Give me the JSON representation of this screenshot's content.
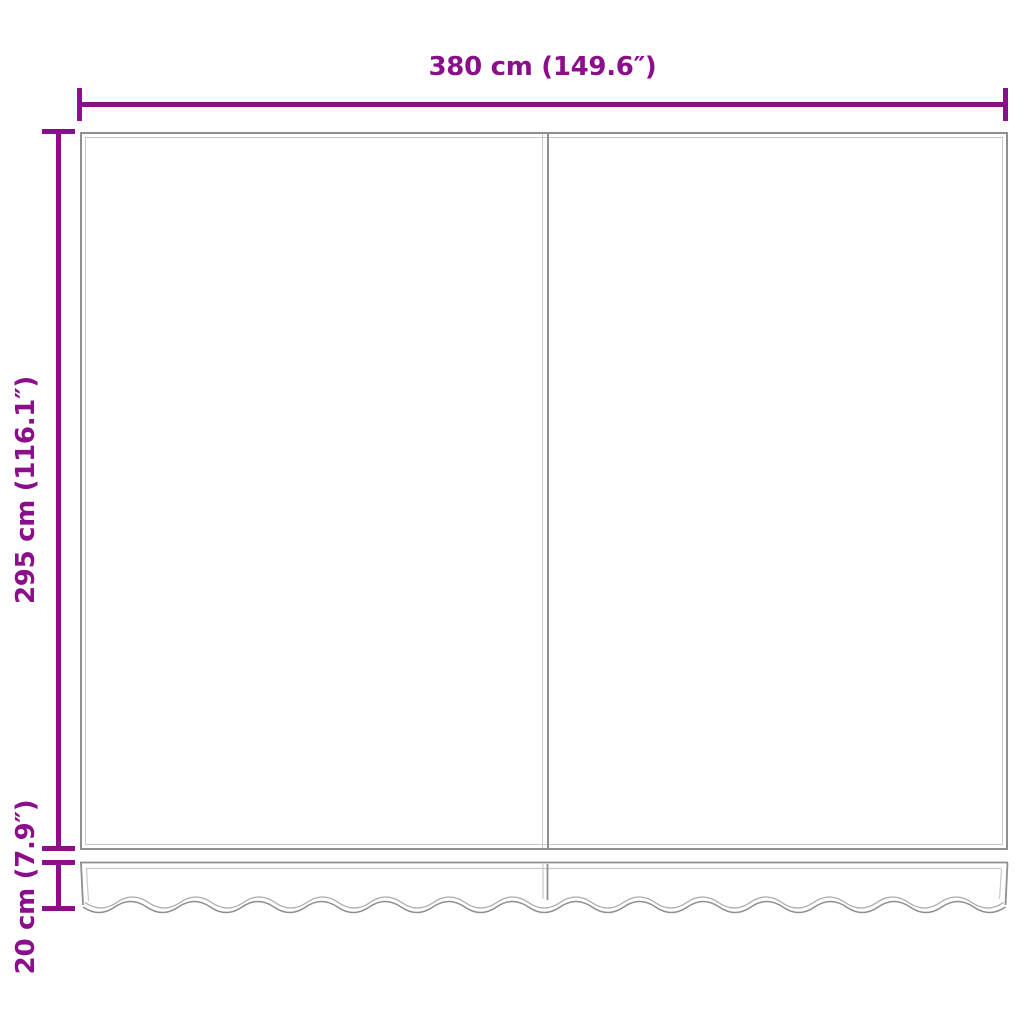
{
  "diagram": {
    "labels": {
      "width": "380 cm (149.6″)",
      "height": "295 cm (116.1″)",
      "valance_height": "20 cm (7.9″)"
    },
    "dimensions": {
      "width_cm": 380,
      "width_inches": 149.6,
      "height_cm": 295,
      "height_inches": 116.1,
      "valance_height_cm": 20,
      "valance_height_inches": 7.9
    },
    "colors": {
      "dimension": "#8B0E8B",
      "outline_dark": "#8F8F8F",
      "outline_light": "#C9C9C9",
      "background": "#FFFFFF"
    }
  }
}
